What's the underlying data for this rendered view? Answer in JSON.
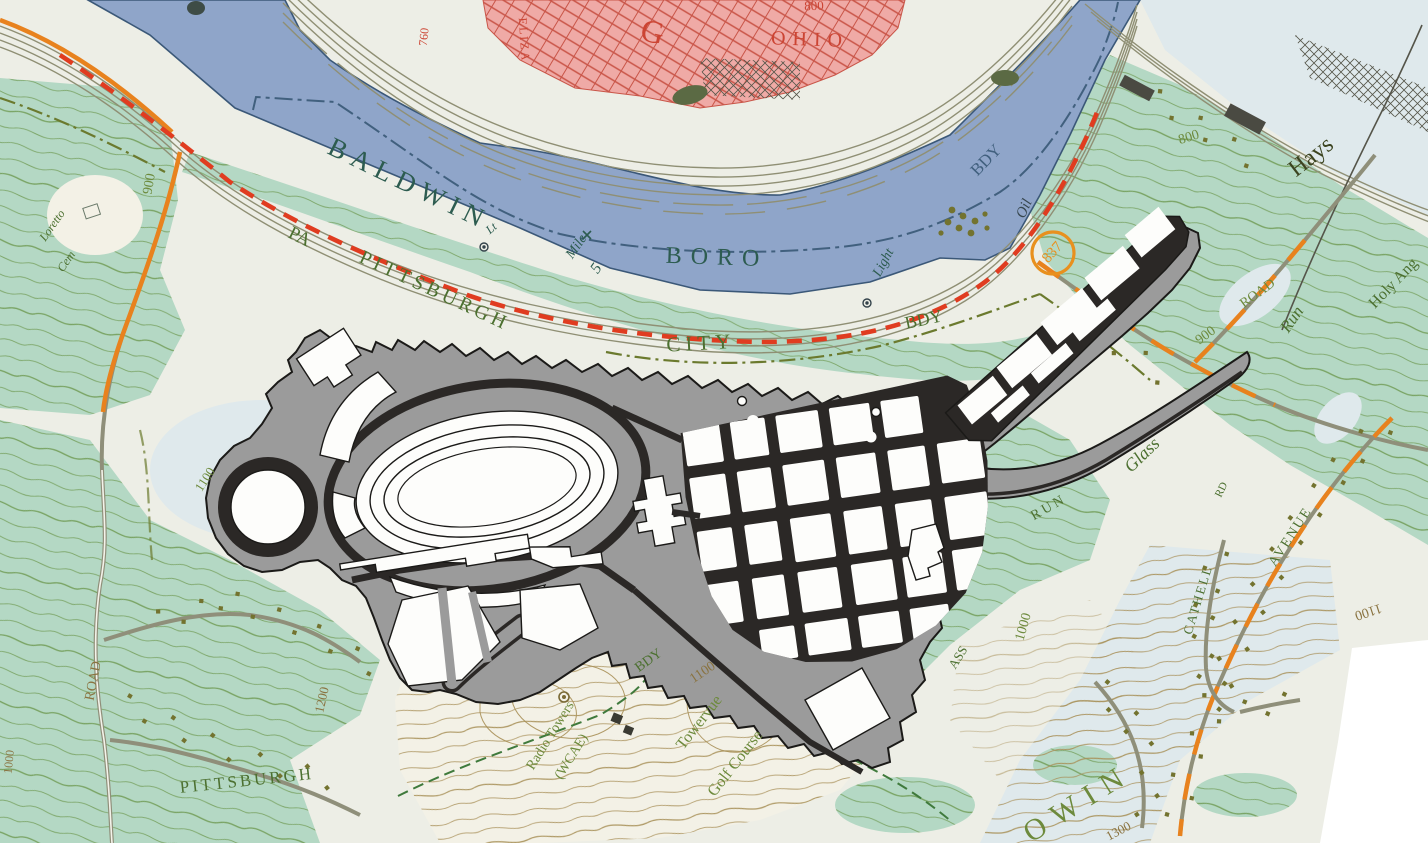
{
  "palette": {
    "land": "#edeee6",
    "pale_clearing": "#f3f1e6",
    "pale_blue": "#dfe9ec",
    "river": "#8fa5c9",
    "shoreline": "#3b5878",
    "woodland": "#b4d8c4",
    "contour_olive": "#6f9a52",
    "contour_brown": "#a89058",
    "urban_pink": "#efaaa6",
    "urban_street_red": "#c95548",
    "rail_gray": "#8f8f74",
    "road_casing": "#8f8f7a",
    "road_orange": "#e8821e",
    "road_red_dash": "#e03c20",
    "house_dot": "#73732f",
    "boundary_olive": "#6b7a2e",
    "boundary_green": "#3f7a3c",
    "label_green": "#4c7030",
    "label_teal": "#2d5c50",
    "label_blue": "#41607e",
    "label_red": "#cc4433",
    "label_olive": "#6d8a3c",
    "label_brown": "#8a7340",
    "label_dark": "#37474f",
    "label_darkolive": "#3c4420",
    "marker_orange": "#e8901e",
    "plan_gray": "#9b9b9b",
    "plan_street": "#2b2826",
    "plan_white": "#fdfdfb",
    "paper": "#ffffff"
  },
  "labels": {
    "baldwin": "BALDWIN",
    "boro": "BORO",
    "pa": "PA",
    "pittsburgh_river": "PITTSBURGH",
    "city": "CITY",
    "bdy_mid": "BDY",
    "bdy_river": "BDY",
    "bdy_bottom": "BDY",
    "oil": "Oil",
    "lt": "Lt",
    "mile": "Mile",
    "mile_number": "5",
    "light": "Light",
    "hays": "Hays",
    "holy_angels": "Holy Ang",
    "road_900": "900",
    "road_900_name": "ROAD",
    "run_upper": "Run",
    "glass": "Glass",
    "run_lower": "RUN",
    "glass_fragment": "ASS",
    "rd_small": "RD",
    "cathell": "CATHELL",
    "avenue": "AVENUE",
    "road_left": "ROAD",
    "pittsburgh_bottom": "PITTSBURGH",
    "towervue": "Towervue",
    "golf_course": "Golf Course",
    "radio_towers": "Radio Towers",
    "radio_call": "(WCAE)",
    "loretto": "Loretto",
    "cem": "Cem",
    "owin": "OWIN",
    "ohio": "OHIO",
    "eliza": "ELIZA",
    "glenwood_initial": "G",
    "red_800": "800",
    "elev_760": "760",
    "route_number": "837"
  },
  "contours": {
    "c900_left": "900",
    "c1100_left": "1100",
    "c1200": "1200",
    "c1000_left": "1000",
    "c800_east": "800",
    "c1000_glass": "1000",
    "c1100_golf": "1100",
    "c1100_cathell": "1100",
    "c1300": "1300"
  }
}
